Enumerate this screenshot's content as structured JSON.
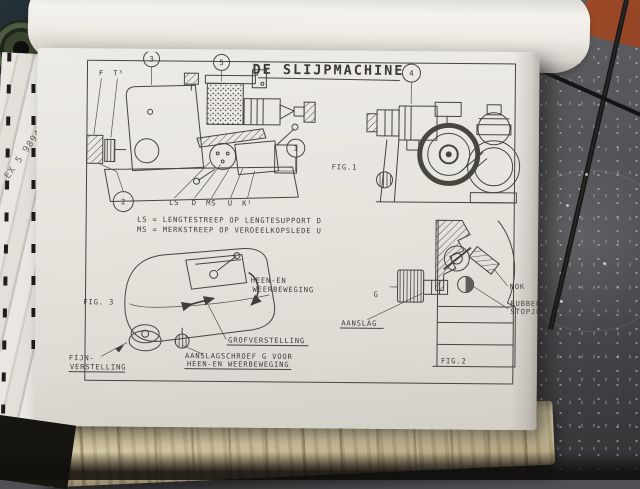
{
  "page": {
    "title": "DE SLIJPMACHINE",
    "legend": {
      "line1": "LS = LENGTESTREEP OP LENGTESUPPORT D",
      "line2": "MS = MERKSTREEP OP VERDEELKOPSLEDE U"
    },
    "axis_labels": {
      "ls": "LS",
      "d": "D",
      "ms": "MS",
      "u": "U",
      "k1": "K¹"
    },
    "part_letters": {
      "f": "F",
      "t3": "T³"
    },
    "callouts": {
      "c1": "1",
      "c2": "2",
      "c3": "3",
      "c4": "4",
      "c5": "5"
    },
    "fig1": {
      "caption": "FIG.1"
    },
    "fig2": {
      "caption": "FIG.2",
      "labels": {
        "g": "G",
        "nok": "NOK",
        "rubber1": "RUBBER",
        "rubber2": "STOPJE.",
        "aanslag": "AANSLAG"
      }
    },
    "fig3": {
      "caption": "FIG. 3",
      "labels": {
        "heen1": "HEEN-EN",
        "heen2": "WEERBEWEGING",
        "grof": "GROFVERSTELLING",
        "fijn1": "FIJN-",
        "fijn2": "VERSTELLING",
        "schroef1": "AANSLAGSCHROEF G VOOR",
        "schroef2": "HEEN-EN WEERBEWEGING"
      }
    }
  },
  "book": {
    "edge_stamp": "EX 5 9894"
  },
  "colors": {
    "paper": "#eae7e1",
    "ink": "#41403b",
    "floor": "#55565a",
    "chair_orange": "#a8502c",
    "book_edge_tan": "#c6b890",
    "rod_black": "#1a1a1a"
  }
}
